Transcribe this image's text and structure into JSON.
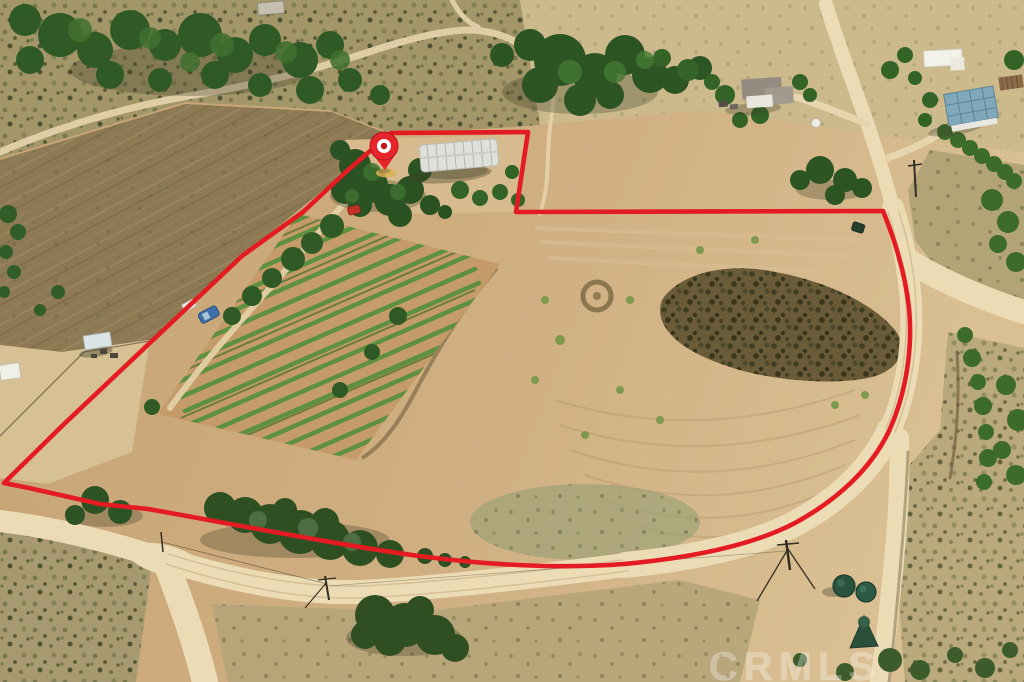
{
  "page": {
    "type": "aerial-property-photo",
    "description": "Drone aerial photograph of a rural land parcel outlined in red, with a red location pin over the homesite, greenhouse, vineyard rows, dirt roads, neighboring houses, water tanks and chaparral hills",
    "width_px": 1024,
    "height_px": 682
  },
  "overlay": {
    "watermark_text": "CRMLS",
    "watermark_color": "#ffffff",
    "boundary_color": "#e41c22",
    "pin_color": "#e8252b",
    "pin_ring_color": "#ffffff"
  },
  "scene": {
    "terrain_tan": "#c9a878",
    "road_color": "#ecdcb6",
    "tree_green": "#33601f",
    "scrub_olive": "#6b6f47",
    "vineyard_row_green": "#5d9140",
    "dark_brush_patch": "#6b5c39",
    "water_tank_green": "#2b5240",
    "greenhouse_roof": "#dfe0da",
    "blue_roof": "#7fa8ba",
    "features": [
      "red property boundary outline",
      "red location pin marker",
      "greenhouse / hoop house",
      "vineyard rows",
      "dirt roads and trails",
      "neighboring houses",
      "blue-roofed barn",
      "green water tanks",
      "power poles",
      "eucalyptus tree line",
      "CRMLS watermark"
    ]
  }
}
